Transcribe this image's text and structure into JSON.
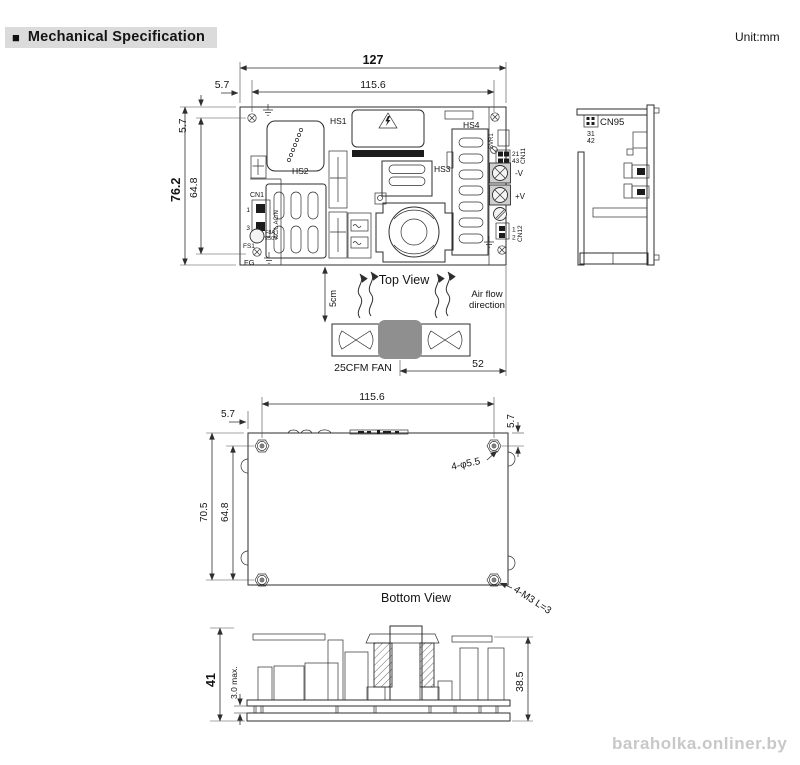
{
  "header": {
    "bullet": "■",
    "title": "Mechanical Specification",
    "unit": "Unit:mm"
  },
  "colors": {
    "line": "#2e2e2e",
    "text": "#141414",
    "title_bg": "#dbdbdb",
    "fan_hub": "#8f8f8f",
    "terminal_fill": "#cfcfcf",
    "watermark": "#c8c8c8",
    "component_dark": "#1c1c1c"
  },
  "top_view": {
    "caption": "Top View",
    "dim_total_width": "127",
    "dim_inner_width": "115.6",
    "dim_left_offset": "5.7",
    "dim_total_height": "76.2",
    "dim_inner_height": "64.8",
    "dim_top_offset": "5.7",
    "hs1": "HS1",
    "hs2": "HS2",
    "hs3": "HS3",
    "hs4": "HS4",
    "cn1": "CN1",
    "cn1_pin_top": "1",
    "cn1_pin_bottom": "3",
    "ac_input": "AC/L AC/N",
    "fs1": "FS1",
    "fuse_rating": "F8A",
    "fuse_voltage": "250V",
    "fg": "FG",
    "svr1": "SVR1",
    "cn11": "CN11",
    "cn11_pins_top": "21",
    "cn11_pins_bottom": "43",
    "v_minus": "-V",
    "v_plus": "+V",
    "cn12": "CN12",
    "cn12_pin_top": "1",
    "cn12_pin_bottom": "2",
    "airflow_clearance": "5cm",
    "airflow_line1": "Air flow",
    "airflow_line2": "direction",
    "fan_label": "25CFM  FAN",
    "fan_dim": "52"
  },
  "side_view": {
    "cn95": "CN95",
    "pins_top": "31",
    "pins_bottom": "42"
  },
  "bottom_view": {
    "caption": "Bottom View",
    "dim_inner_width": "115.6",
    "dim_left_offset": "5.7",
    "dim_top_offset": "5.7",
    "dim_total_height": "70.5",
    "dim_inner_height": "64.8",
    "hole_note": "4-φ5.5",
    "screw_note": "4-M3 L=3"
  },
  "front_view": {
    "dim_total_height": "41",
    "dim_pin_protrusion": "3.0 max.",
    "dim_body_height": "38.5"
  },
  "watermark": {
    "text": "baraholka.onliner.by"
  }
}
